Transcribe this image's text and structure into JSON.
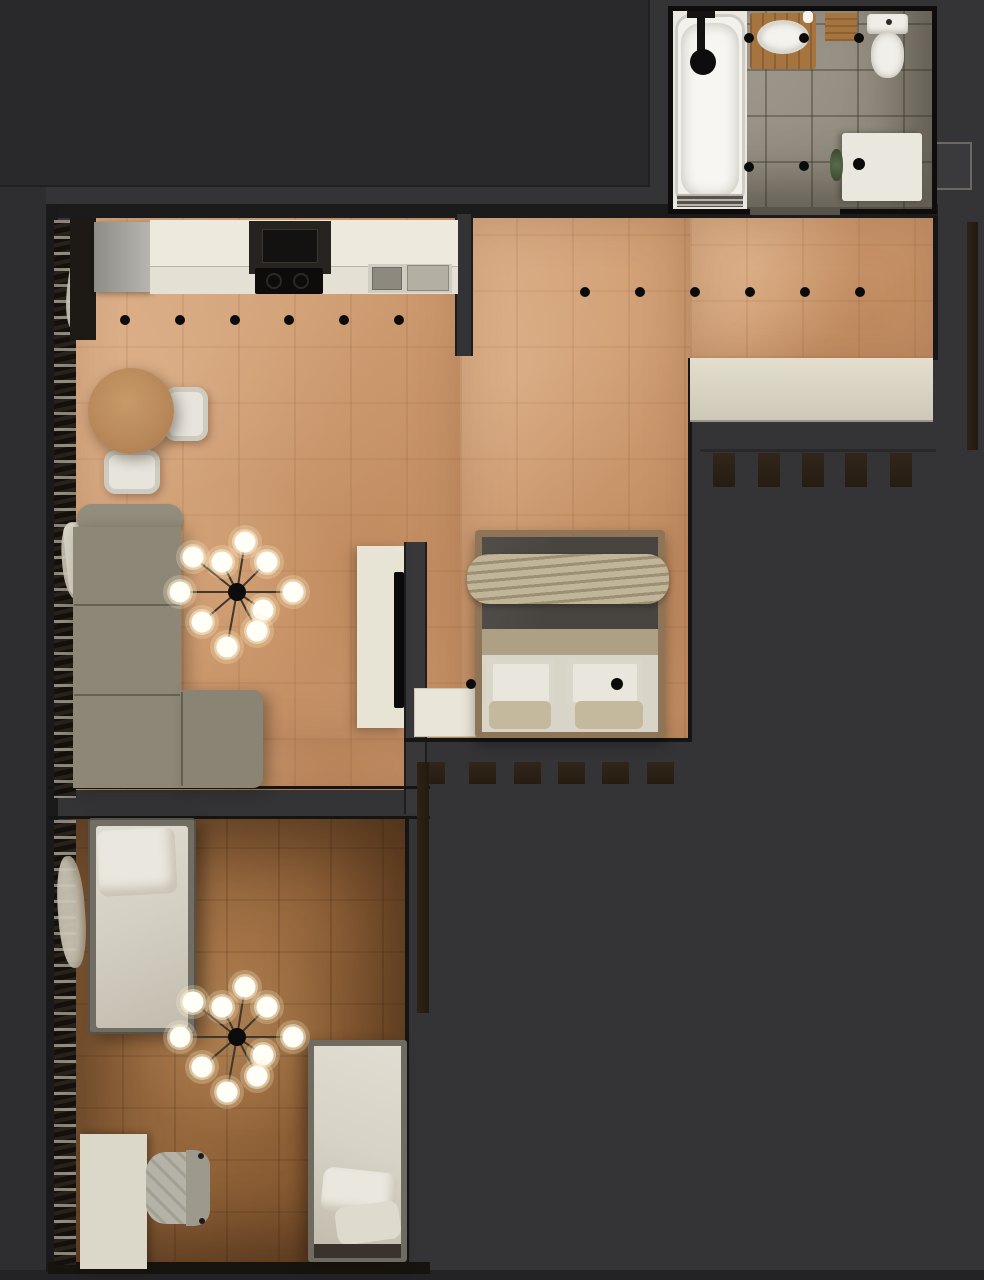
{
  "scene": {
    "description": "Top-down 3D rendered floor plan of a small apartment",
    "rooms": [
      "bathroom",
      "kitchen-living-area",
      "sleeping-area",
      "kids-room"
    ],
    "furniture": [
      "bathtub",
      "shower-head",
      "vanity-with-sink",
      "bath-mat",
      "toilet",
      "washing-machine",
      "plant",
      "fridge",
      "kitchen-counter",
      "range-hood",
      "cooktop",
      "kitchen-sink",
      "dining-table",
      "dining-chair",
      "corner-sofa",
      "tv-stand",
      "tv",
      "dresser",
      "double-bed",
      "throw-blanket",
      "pillows",
      "wardrobe",
      "single-bed",
      "desk",
      "office-chair",
      "curtains",
      "radiator"
    ]
  },
  "palette": {
    "background": "#343437",
    "background_top": "#29292b",
    "wood_light": "#d2a077",
    "wood_dark": "#a06f41",
    "tile_gray": "#938d80",
    "counter_cream": "#eee9dd",
    "sofa_taupe": "#8d8777",
    "bed_blanket_gray": "#474340",
    "throw_beige": "#b2a588",
    "radiator_brown": "#2d2114",
    "bulb_glow": "#fff4d6"
  },
  "lights": {
    "ceiling_spots_living": {
      "y": 320,
      "r": 5,
      "xs": [
        125,
        180,
        235,
        289,
        344,
        399
      ]
    },
    "ceiling_spots_bedroom": {
      "y": 292,
      "r": 5,
      "xs": [
        585,
        640,
        695,
        750,
        805,
        860
      ]
    },
    "bed_spots": [
      [
        471,
        684,
        5
      ],
      [
        617,
        684,
        6
      ]
    ],
    "bathroom_spots": [
      [
        749,
        38,
        5
      ],
      [
        804,
        38,
        5
      ],
      [
        859,
        38,
        5
      ],
      [
        749,
        167,
        5
      ],
      [
        804,
        166,
        5
      ],
      [
        859,
        164,
        6
      ]
    ],
    "chandeliers": [
      {
        "cx": 237,
        "cy": 592,
        "bulbs": [
          [
            245,
            542
          ],
          [
            193,
            557
          ],
          [
            222,
            562
          ],
          [
            267,
            562
          ],
          [
            180,
            592
          ],
          [
            293,
            592
          ],
          [
            263,
            610
          ],
          [
            202,
            622
          ],
          [
            257,
            631
          ],
          [
            227,
            647
          ]
        ]
      },
      {
        "cx": 237,
        "cy": 1037,
        "bulbs": [
          [
            245,
            987
          ],
          [
            193,
            1002
          ],
          [
            222,
            1007
          ],
          [
            267,
            1007
          ],
          [
            180,
            1037
          ],
          [
            293,
            1037
          ],
          [
            263,
            1055
          ],
          [
            202,
            1067
          ],
          [
            257,
            1076
          ],
          [
            227,
            1092
          ]
        ]
      }
    ]
  },
  "radiators": {
    "hall_row": {
      "y": 453,
      "w": 22,
      "h": 34,
      "xs": [
        713,
        758,
        802,
        845,
        890
      ]
    },
    "bedroom_row": {
      "y": 762,
      "w": 27,
      "h": 22,
      "xs": [
        418,
        469,
        514,
        558,
        602,
        647
      ]
    },
    "vertical_strip": {
      "x": 417,
      "y": 762,
      "w": 12,
      "h": 251
    },
    "right_strip": {
      "x": 967,
      "y": 222,
      "w": 11,
      "h": 228
    }
  }
}
